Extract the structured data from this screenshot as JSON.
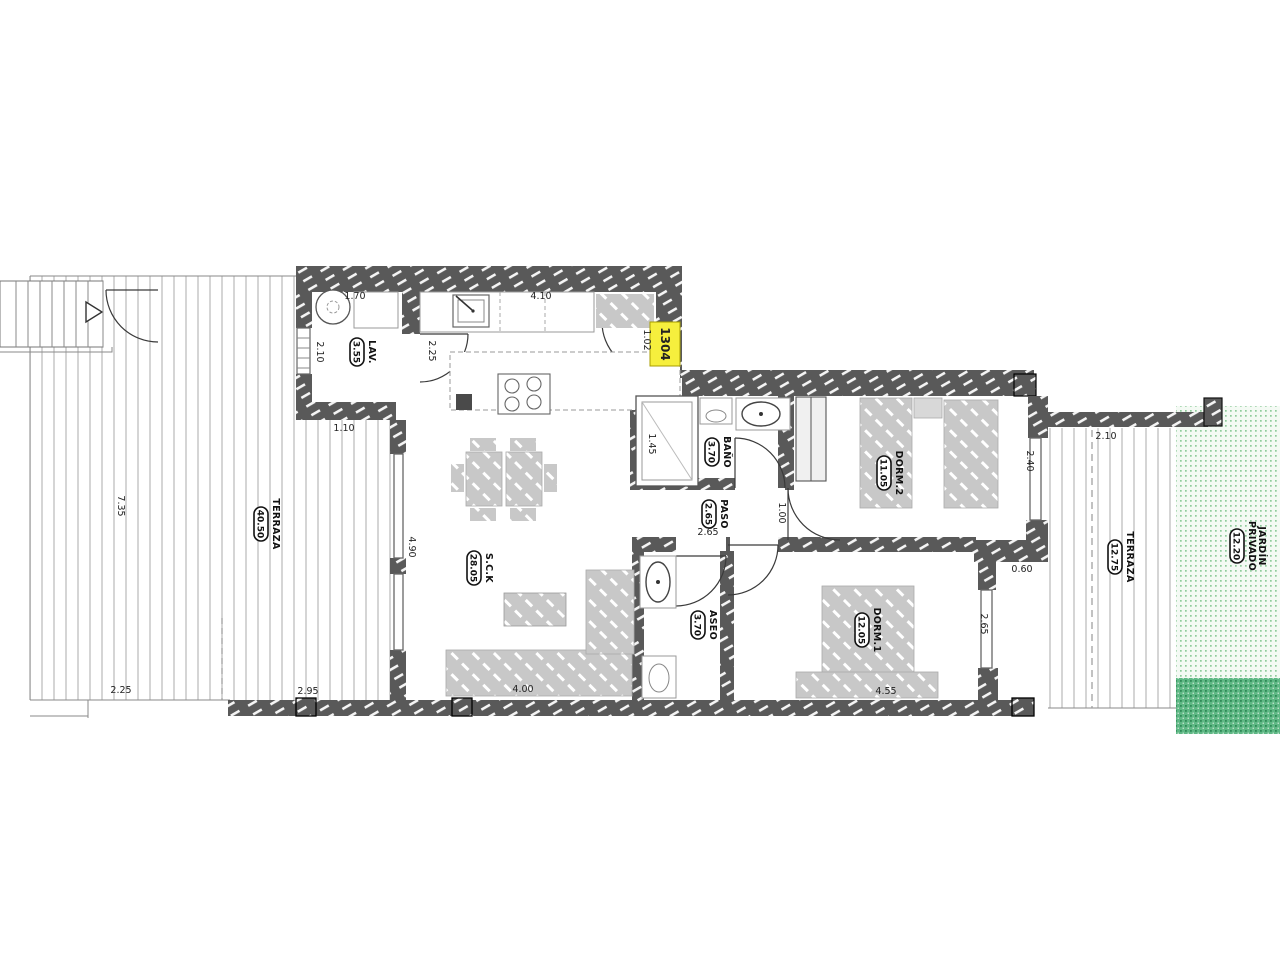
{
  "drawing_type": "apartment-floor-plan",
  "unit_tag": "1304",
  "rooms": {
    "lav": {
      "name": "LAV.",
      "area": "3.55"
    },
    "sck": {
      "name": "S.C.K",
      "area": "28.05"
    },
    "banio": {
      "name": "BAÑO",
      "area": "3.70"
    },
    "paso": {
      "name": "PASO",
      "area": "2.65"
    },
    "dorm2": {
      "name": "DORM.2",
      "area": "11.05"
    },
    "dorm1": {
      "name": "DORM.1",
      "area": "12.05"
    },
    "aseo": {
      "name": "ASEO",
      "area": "3.70"
    },
    "terraza_izq": {
      "name": "TERRAZA",
      "area": "40.50"
    },
    "terraza_der": {
      "name": "TERRAZA",
      "area": "12.75"
    },
    "jardin": {
      "name_line1": "JARDÍN",
      "name_line2": "PRIVADO",
      "area": "12.20"
    }
  },
  "dimensions": [
    {
      "text": "1.70"
    },
    {
      "text": "2.10"
    },
    {
      "text": "2.25"
    },
    {
      "text": "1.10"
    },
    {
      "text": "4.10"
    },
    {
      "text": "1.02"
    },
    {
      "text": "1.45"
    },
    {
      "text": "2.65"
    },
    {
      "text": "1.00"
    },
    {
      "text": "2.40"
    },
    {
      "text": "0.60"
    },
    {
      "text": "2.65"
    },
    {
      "text": "4.55"
    },
    {
      "text": "4.00"
    },
    {
      "text": "2.95"
    },
    {
      "text": "2.25"
    },
    {
      "text": "4.90"
    },
    {
      "text": "7.35"
    },
    {
      "text": "2.10"
    }
  ],
  "colors": {
    "wall": "#595959",
    "furniture": "#c8c8c8",
    "deck_line": "#c3c3c3",
    "garden_light_dot": "#8fcb9b",
    "garden_light_bg": "#f4faf4",
    "garden_dark_bg": "#5fb885",
    "garden_dark_dot": "#2e8a56",
    "tag_bg": "#f6ef3d"
  }
}
